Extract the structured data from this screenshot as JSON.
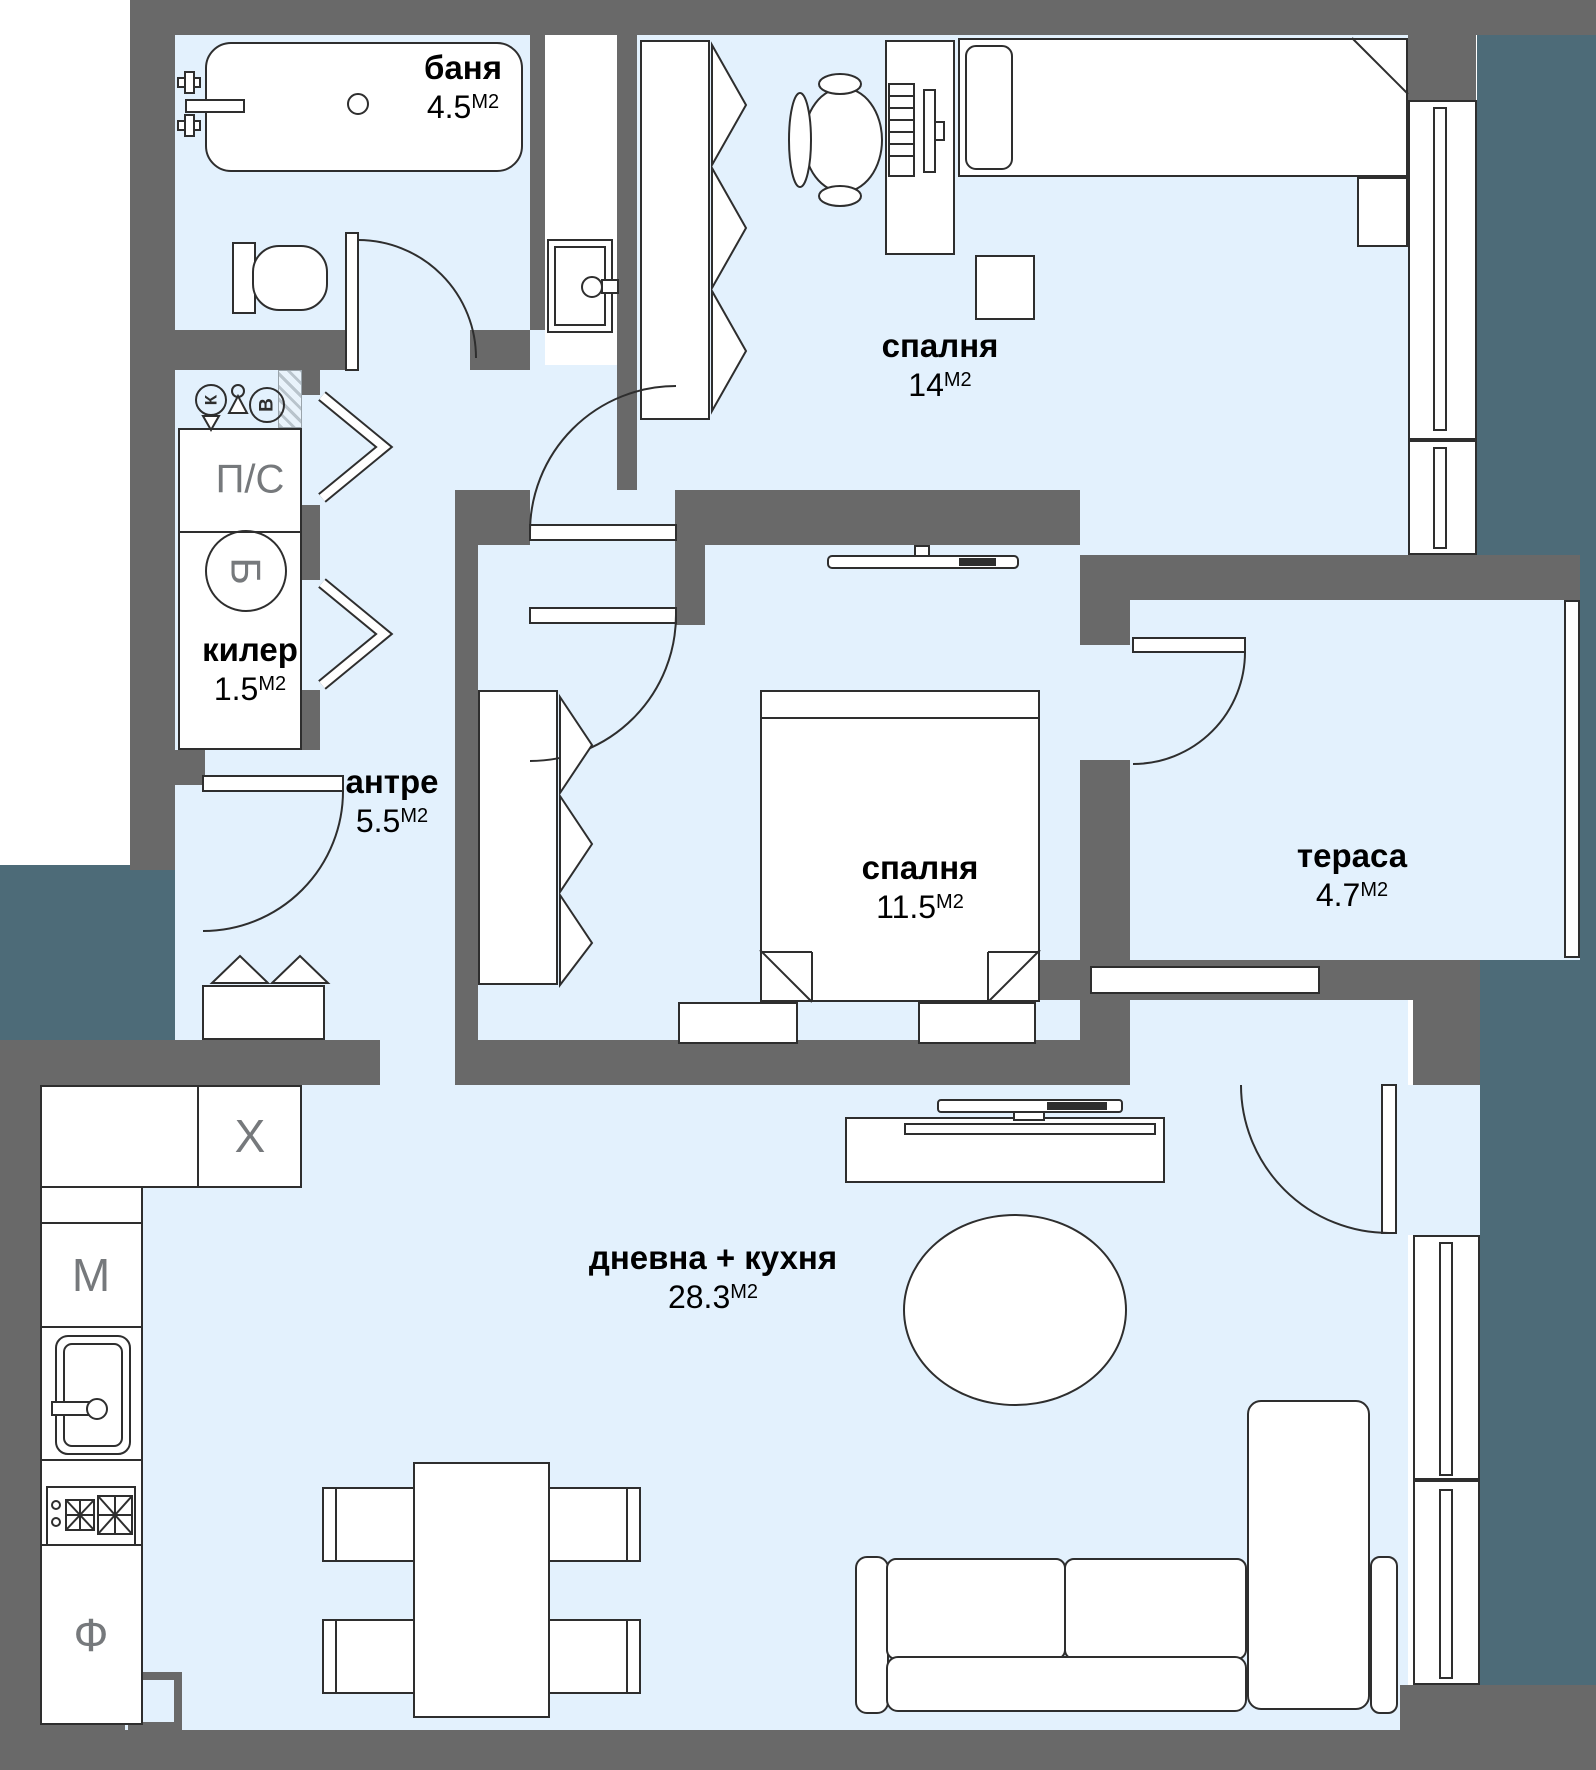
{
  "title": "apartment floor plan",
  "colors": {
    "wall": "#696969",
    "floor": "#e3f1fd",
    "exterior": "#4d6b78",
    "line": "#2e2e2e",
    "accent_letter": "#76797c"
  },
  "rooms": [
    {
      "id": "banya",
      "name": "баня",
      "area": "4.5",
      "unit": "М2"
    },
    {
      "id": "spalnya-1",
      "name": "спалня",
      "area": "14",
      "unit": "М2"
    },
    {
      "id": "kiler",
      "name": "килер",
      "area": "1.5",
      "unit": "М2"
    },
    {
      "id": "antre",
      "name": "антре",
      "area": "5.5",
      "unit": "М2"
    },
    {
      "id": "spalnya-2",
      "name": "спалня",
      "area": "11.5",
      "unit": "М2"
    },
    {
      "id": "terasa",
      "name": "тераса",
      "area": "4.7",
      "unit": "М2"
    },
    {
      "id": "dnevna-kuhnya",
      "name": "дневна + кухня",
      "area": "28.3",
      "unit": "М2"
    }
  ],
  "annotations": {
    "utility_closet": "П/С",
    "boiler": "Б",
    "fridge": "Х",
    "dishwasher": "М",
    "oven": "Ф",
    "duct_k": "К",
    "duct_v": "В"
  }
}
